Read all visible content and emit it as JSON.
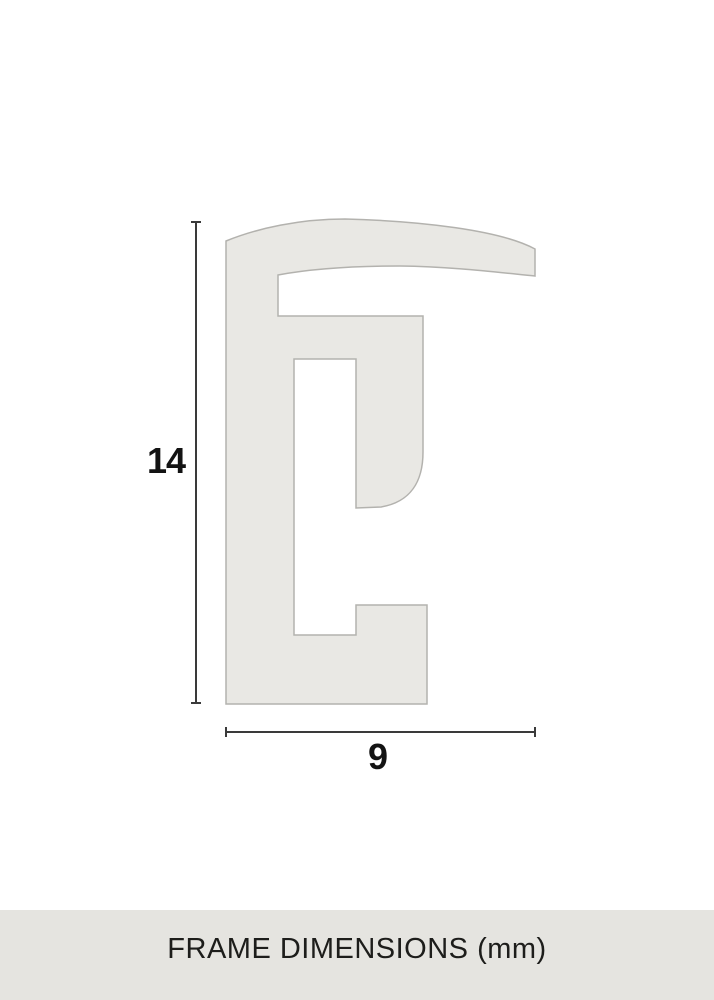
{
  "diagram": {
    "height_label": "14",
    "width_label": "9"
  },
  "footer": {
    "caption": "FRAME DIMENSIONS (mm)"
  },
  "colors": {
    "page_background": "#ffffff",
    "profile_fill": "#e9e8e4",
    "profile_stroke": "#b3b2ae",
    "dimension_line": "#3a3a3a",
    "label_text": "#131313",
    "footer_background": "#e5e4e0",
    "footer_text": "#1d1d1b"
  }
}
